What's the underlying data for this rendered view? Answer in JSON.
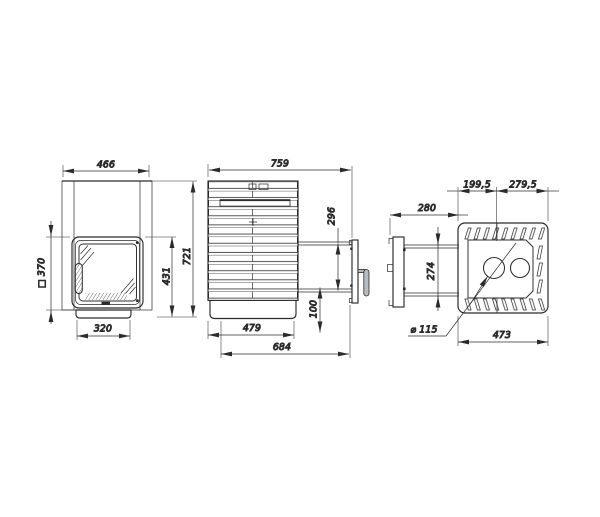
{
  "dims": {
    "front": {
      "width": "466",
      "stone_opening": "□ 370",
      "base_width": "320",
      "door_height": "431",
      "overall_height": "721"
    },
    "side": {
      "overall_depth": "759",
      "firebox_door_height": "296",
      "plinth_height": "100",
      "body_depth": "479",
      "depth_with_tunnel": "684"
    },
    "top": {
      "chimney_offset_front": "199,5",
      "chimney_offset_rear": "279,5",
      "tunnel_length": "280",
      "tunnel_width": "274",
      "chimney_diameter": "⌀ 115",
      "overall_width": "473"
    }
  },
  "colors": {
    "line": "#2b2b2b",
    "handle_fill": "#b6bcc2"
  }
}
